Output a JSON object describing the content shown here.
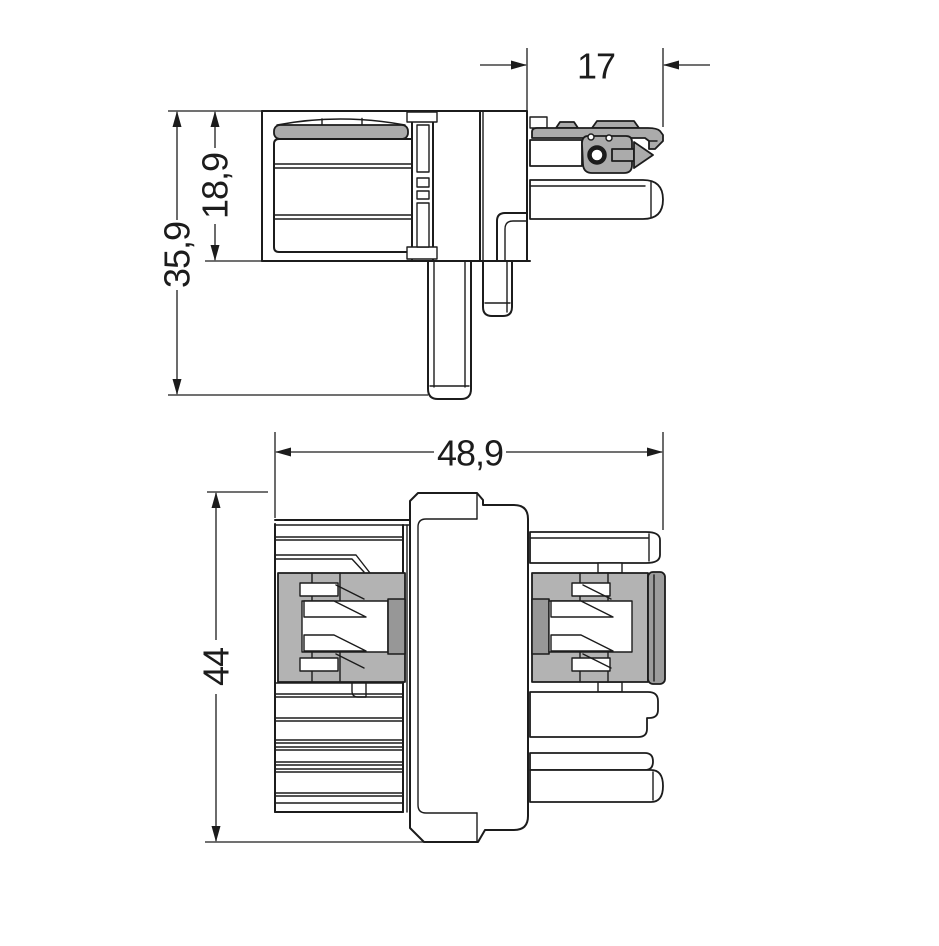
{
  "drawing": {
    "dimensions": {
      "side_view": [
        {
          "id": "arm-width",
          "value": "17"
        },
        {
          "id": "socket-height",
          "value": "18,9"
        },
        {
          "id": "overall-height",
          "value": "35,9"
        }
      ],
      "front_view": [
        {
          "id": "overall-width",
          "value": "48,9"
        },
        {
          "id": "overall-height",
          "value": "44"
        }
      ]
    }
  },
  "colors": {
    "line": "#1c1c1c",
    "part_gray": "#ababab",
    "frame_gray": "#b3b3b3",
    "wall_gray": "#979797",
    "cap_gray": "#9c9c9c",
    "background": "#ffffff"
  }
}
